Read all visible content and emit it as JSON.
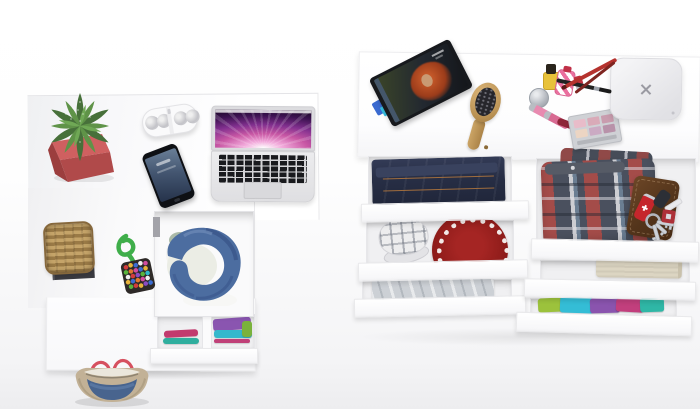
{
  "scene": {
    "description": "Top-down 3D product render: white L-shaped desk with accessories and open storage drawers (left) and a wide white dresser with open drawers full of clothes and personal items (right), on a white floor",
    "background_color": "#f4f4f6",
    "furniture_color": "#ffffff"
  },
  "desk": {
    "label": "white desk, top view",
    "items": {
      "cactus": {
        "label": "spiky green cactus in square red-pink pot",
        "pot_color": "#b94f4f",
        "plant_color": "#4e8040"
      },
      "speaker": {
        "label": "white pill-shaped bluetooth speaker with four round grilles",
        "color": "#fafafb"
      },
      "phone": {
        "label": "black smartphone with dark blue lock screen",
        "body_color": "#0e1014",
        "screen_color": "#445671"
      },
      "laptop": {
        "label": "open silver laptop with pink-purple aurora wallpaper, black keys and trackpad",
        "body_color": "#e4e4e6",
        "wallpaper_colors": [
          "#ffffff",
          "#f2aadb",
          "#c857a4",
          "#82308f",
          "#1d0828"
        ]
      },
      "basket": {
        "label": "tan woven wicker basket on dark gray tray",
        "basket_color": "#b5945f",
        "tray_color": "#3a3a40"
      },
      "bead_toy": {
        "label": "multicolor beaded pouch with green cord knot",
        "cord_color": "#3fae4a",
        "pouch_color": "#2e2a28"
      },
      "open_drawer_jacket": {
        "label": "open drawer holding crumpled blue denim jacket with cream lining",
        "jacket_color": "#4c6da0",
        "lining_color": "#ebede5"
      },
      "lower_drawer_folds": {
        "label": "half-open drawer with folded clothes in divided compartments",
        "colors": [
          "#c23a6e",
          "#2fae9e",
          "#8a55b0",
          "#35b8cc",
          "#7ab23c"
        ]
      },
      "handbag": {
        "label": "tote bag with tan sides, denim blue panel and red handles, on floor",
        "body_color": "#c2b196",
        "panel_color": "#48648e",
        "handle_color": "#d6505f"
      }
    }
  },
  "dresser": {
    "label": "white dresser with two columns of open drawers, top view",
    "top_items": {
      "tablet": {
        "label": "tilted tablet on stand showing photo of red-haired woman",
        "frame_color": "#17191d",
        "stand_color": "#3a6ad0"
      },
      "hairbrush": {
        "label": "wooden oval hairbrush with black bristle pad",
        "wood_color": "#bb9355"
      },
      "makeup_set": {
        "label": "makeup collection: yellow nail polish, silver jar, striped pink perfume, lipstick, crossed brushes and pencils, pink gloss tubes, eyeshadow palette",
        "palette_pan_colors": [
          "#e8bcc9",
          "#d9aab8",
          "#c99cae",
          "#ecd5c3",
          "#cbaac3",
          "#b892a9"
        ]
      },
      "x_device": {
        "label": "light gray rounded-square wireless charger with X mark",
        "color": "#e9e9ec"
      }
    },
    "drawer_items": {
      "jeans": {
        "label": "folded dark indigo jeans with orange stitching",
        "color": "#272e45"
      },
      "plaid_cap": {
        "label": "white and gray plaid baseball cap",
        "color": "#ededee"
      },
      "red_hat": {
        "label": "dark red knit hat with white loop pattern around rim",
        "color": "#8c1b19"
      },
      "gray_clothes": {
        "label": "folded light gray garment",
        "color": "#ccd0d5"
      },
      "plaid_shorts": {
        "label": "red, gray and blue tartan plaid shorts",
        "colors": [
          "#a84642",
          "#464c5a",
          "#e0e0e4",
          "#5c7a98"
        ]
      },
      "wallet": {
        "label": "brown leather wallet",
        "color": "#53341b"
      },
      "swiss_knife": {
        "label": "red pocket knife with white cross",
        "color": "#c5262c"
      },
      "keys": {
        "label": "key ring with three keys, black car fob and red keychain",
        "color": "#cdd0d6"
      },
      "beige_sweater": {
        "label": "folded beige knit sweater",
        "color": "#dcd5c2"
      },
      "colorful_stack": {
        "label": "row of folded colorful shirts",
        "colors": [
          "#9cc23c",
          "#34bdd6",
          "#8a54ae",
          "#c23f7d",
          "#2fb7a6"
        ]
      }
    }
  }
}
